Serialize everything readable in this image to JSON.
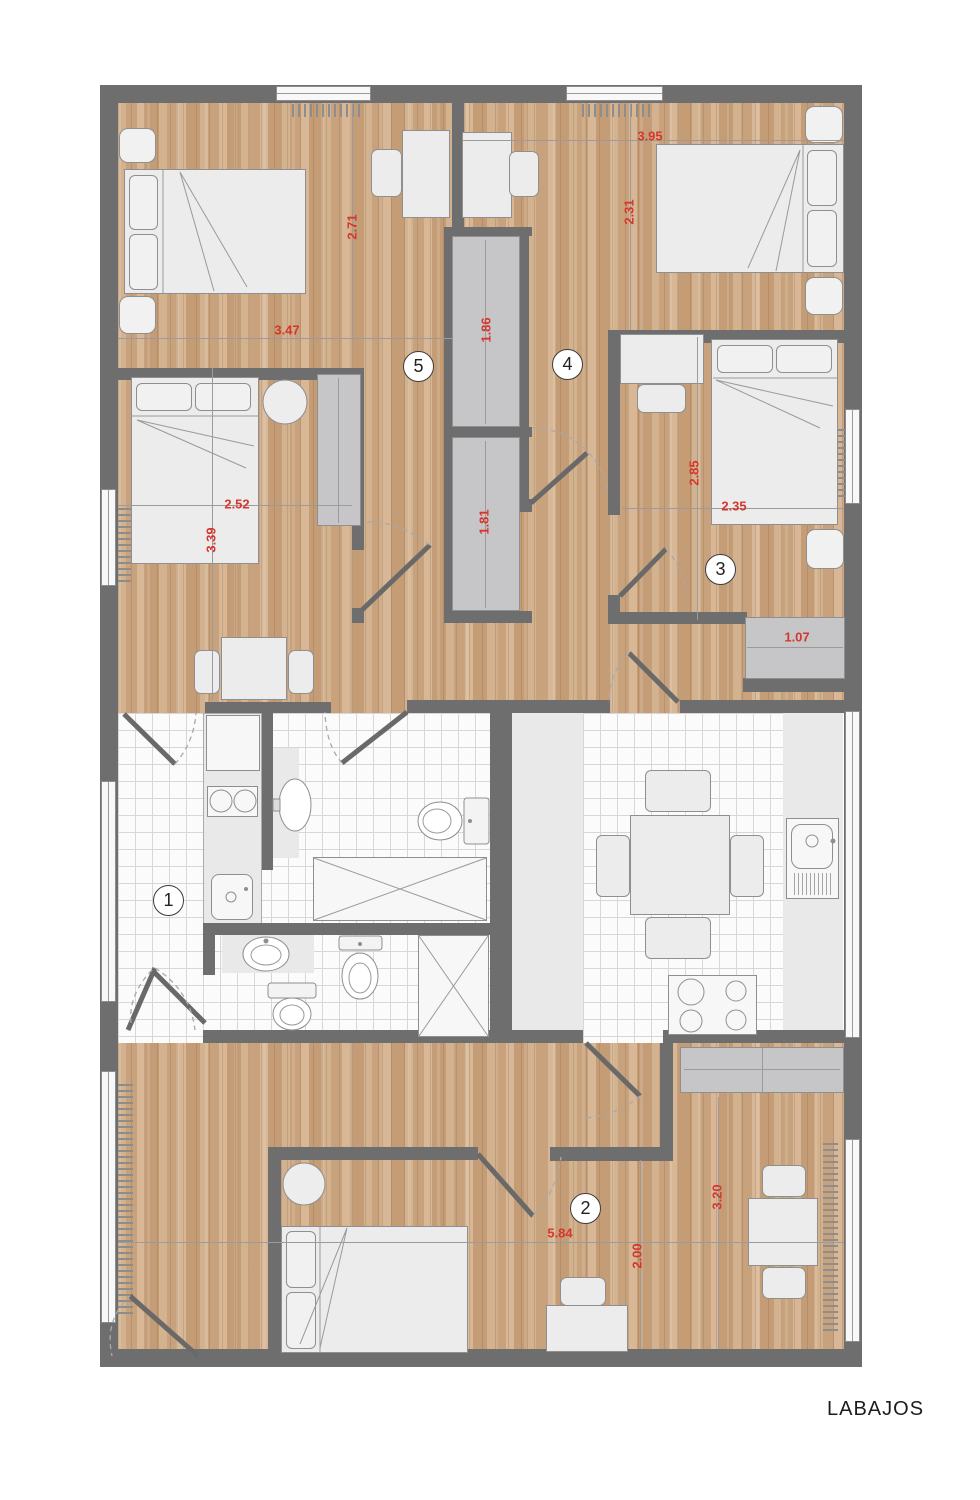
{
  "title": "LABAJOS",
  "room_numbers": {
    "n1": "1",
    "n2": "2",
    "n3": "3",
    "n4": "4",
    "n5": "5"
  },
  "dimensions": {
    "room5_width": "3.47",
    "room5_height": "2.71",
    "room4_width": "3.95",
    "room4_height": "2.31",
    "room3_height": "2.85",
    "room3_width": "2.35",
    "room3_closet": "1.07",
    "roomL_width": "2.52",
    "roomL_height": "3.39",
    "hall_closet_upper": "1.86",
    "hall_closet_lower": "1.81",
    "room2_width": "5.84",
    "room2_height_inner": "2.00",
    "room2_height_right": "3.20"
  },
  "colors": {
    "wall": "#6e6e6e",
    "wood": "#cdaa86",
    "dimension_red": "#d5372c",
    "tile_line": "#d7d7d7",
    "closet_gray": "#c6c6c8"
  }
}
